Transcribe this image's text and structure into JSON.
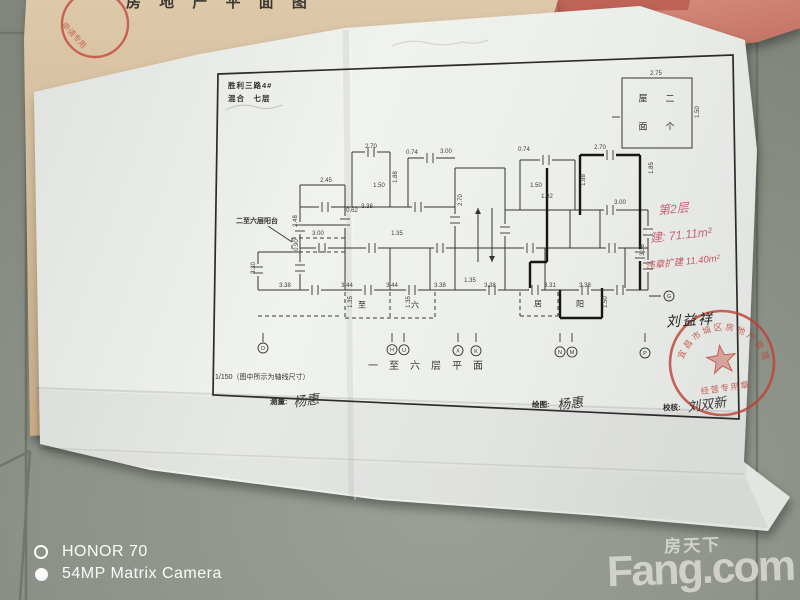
{
  "scene": {
    "floor_color": "#8d9288",
    "grout_color": "#6b7065",
    "tan_paper_color": "#d6bf9f",
    "pink_paper_color": "#d2897b",
    "white_paper_color": "#eceeea",
    "ink_color": "#343434",
    "stamp_red": "#bf4034",
    "hand_red": "#c5566c"
  },
  "watermarks": {
    "camera_line1": "HONOR 70",
    "camera_line2": "54MP Matrix Camera",
    "brand_cn": "房天下",
    "brand_en": "Fang.com"
  },
  "top_paper": {
    "fragment_text": "房 地 产 平 面 图",
    "stamp_text": "申请专用"
  },
  "drawing": {
    "title_line1": "胜利三路4#",
    "title_line2": "混合　七层",
    "roof_box": {
      "dim_top": "2.75",
      "dim_right": "1.50",
      "chars": [
        "屋",
        "二",
        "面",
        "个"
      ]
    },
    "balcony_note": "二至六层阳台",
    "caption": "一至六层平面",
    "scale_note": "1/150（图中所示为轴线尺寸）",
    "sign_measure_label": "测量:",
    "sign_measure_name": "杨惠",
    "sign_draw_label": "绘图:",
    "sign_draw_name": "杨惠",
    "sign_check_label": "校核:",
    "sign_check_name": "刘双新",
    "red_note_line1": "第2层",
    "red_note_line2": "建: 71.11m²",
    "red_note_line3": "违章扩建 11.40m²",
    "owner_name": "刘益祥",
    "axis_right_letter": "G",
    "stamp": {
      "arc_text": "宜昌市城区房地产管理所",
      "bottom_text": "经营专用章"
    },
    "axis_bubbles": [
      {
        "l": "D",
        "x": 263
      },
      {
        "l": "H",
        "x": 392
      },
      {
        "l": "U",
        "x": 404
      },
      {
        "l": "X",
        "x": 458
      },
      {
        "l": "K",
        "x": 476
      },
      {
        "l": "N",
        "x": 560
      },
      {
        "l": "M",
        "x": 572
      },
      {
        "l": "P",
        "x": 645
      }
    ],
    "room_chars": [
      {
        "t": "至",
        "x": 362,
        "y": 305
      },
      {
        "t": "六",
        "x": 415,
        "y": 305
      },
      {
        "t": "居",
        "x": 538,
        "y": 304
      },
      {
        "t": "阳",
        "x": 580,
        "y": 304
      }
    ],
    "roof_chars": [
      {
        "t": "屋",
        "x": 643,
        "y": 98
      },
      {
        "t": "二",
        "x": 670,
        "y": 98
      },
      {
        "t": "面",
        "x": 643,
        "y": 126
      },
      {
        "t": "个",
        "x": 670,
        "y": 126
      }
    ],
    "dim_labels": [
      {
        "t": "2.70",
        "x": 371,
        "y": 147
      },
      {
        "t": "0.74",
        "x": 412,
        "y": 153
      },
      {
        "t": "3.00",
        "x": 446,
        "y": 152
      },
      {
        "t": "0.74",
        "x": 524,
        "y": 150
      },
      {
        "t": "2.70",
        "x": 600,
        "y": 148
      },
      {
        "t": "1.85",
        "x": 652,
        "y": 168,
        "r": 1
      },
      {
        "t": "1.88",
        "x": 396,
        "y": 177,
        "r": 1
      },
      {
        "t": "1.88",
        "x": 584,
        "y": 180,
        "r": 1
      },
      {
        "t": "1.50",
        "x": 379,
        "y": 186
      },
      {
        "t": "0.62",
        "x": 352,
        "y": 211
      },
      {
        "t": "1.50",
        "x": 536,
        "y": 186
      },
      {
        "t": "3.38",
        "x": 367,
        "y": 207
      },
      {
        "t": "1.02",
        "x": 547,
        "y": 197
      },
      {
        "t": "3.00",
        "x": 620,
        "y": 203
      },
      {
        "t": "2.45",
        "x": 326,
        "y": 181
      },
      {
        "t": "2.48",
        "x": 296,
        "y": 221,
        "r": 1
      },
      {
        "t": "3.30",
        "x": 254,
        "y": 268,
        "r": 1
      },
      {
        "t": "2.70",
        "x": 461,
        "y": 200,
        "r": 1
      },
      {
        "t": "1.35",
        "x": 397,
        "y": 234
      },
      {
        "t": "1.35",
        "x": 470,
        "y": 281
      },
      {
        "t": "3.36",
        "x": 643,
        "y": 250,
        "r": 1
      },
      {
        "t": "3.38",
        "x": 285,
        "y": 286
      },
      {
        "t": "3.44",
        "x": 347,
        "y": 286
      },
      {
        "t": "3.44",
        "x": 392,
        "y": 286
      },
      {
        "t": "3.38",
        "x": 440,
        "y": 286
      },
      {
        "t": "3.38",
        "x": 490,
        "y": 286
      },
      {
        "t": "3.31",
        "x": 550,
        "y": 286
      },
      {
        "t": "3.38",
        "x": 585,
        "y": 286
      },
      {
        "t": "1.35",
        "x": 351,
        "y": 302,
        "r": 1
      },
      {
        "t": "1.35",
        "x": 409,
        "y": 302,
        "r": 1
      },
      {
        "t": "1.50",
        "x": 606,
        "y": 302,
        "r": 1
      },
      {
        "t": "3.00",
        "x": 318,
        "y": 234
      },
      {
        "t": "0.90",
        "x": 297,
        "y": 245,
        "r": 1
      },
      {
        "t": "2.75",
        "x": 656,
        "y": 74
      },
      {
        "t": "1.50",
        "x": 698,
        "y": 112,
        "r": 1
      }
    ],
    "plan": {
      "frame": [
        218,
        74,
        733,
        55,
        739,
        419,
        213,
        395
      ],
      "roof_rect": [
        622,
        78,
        70,
        70
      ],
      "walls": [
        [
          258,
          290,
          648,
          290
        ],
        [
          300,
          248,
          648,
          248
        ],
        [
          300,
          207,
          455,
          207
        ],
        [
          505,
          210,
          648,
          210
        ],
        [
          300,
          185,
          345,
          185
        ],
        [
          258,
          252,
          300,
          252
        ],
        [
          258,
          252,
          258,
          290
        ],
        [
          300,
          185,
          300,
          290
        ],
        [
          345,
          185,
          345,
          290
        ],
        [
          390,
          152,
          390,
          207
        ],
        [
          390,
          248,
          390,
          290
        ],
        [
          430,
          248,
          430,
          290
        ],
        [
          455,
          168,
          455,
          290
        ],
        [
          505,
          168,
          505,
          290
        ],
        [
          455,
          168,
          505,
          168
        ],
        [
          352,
          152,
          390,
          152
        ],
        [
          352,
          152,
          352,
          207
        ],
        [
          408,
          158,
          455,
          158
        ],
        [
          408,
          158,
          408,
          207
        ],
        [
          520,
          160,
          575,
          160
        ],
        [
          520,
          160,
          520,
          210
        ],
        [
          575,
          160,
          575,
          210
        ],
        [
          570,
          210,
          570,
          248
        ],
        [
          600,
          210,
          600,
          248
        ],
        [
          625,
          248,
          625,
          290
        ],
        [
          648,
          210,
          648,
          290
        ],
        [
          545,
          248,
          545,
          290
        ],
        [
          300,
          225,
          345,
          225
        ]
      ],
      "bold": [
        [
          580,
          155,
          640,
          155
        ],
        [
          580,
          155,
          580,
          215
        ],
        [
          640,
          155,
          640,
          215
        ],
        [
          640,
          215,
          640,
          290
        ],
        [
          547,
          168,
          547,
          262
        ],
        [
          547,
          262,
          530,
          262
        ],
        [
          530,
          262,
          530,
          290
        ],
        [
          560,
          290,
          560,
          318
        ],
        [
          560,
          318,
          602,
          318
        ],
        [
          602,
          318,
          602,
          288
        ]
      ],
      "dashed": [
        [
          345,
          292,
          345,
          318
        ],
        [
          435,
          292,
          435,
          318
        ],
        [
          345,
          318,
          435,
          318
        ],
        [
          390,
          292,
          390,
          318
        ],
        [
          520,
          292,
          520,
          316
        ],
        [
          558,
          292,
          558,
          316
        ],
        [
          520,
          316,
          558,
          316
        ],
        [
          292,
          238,
          345,
          238
        ],
        [
          292,
          238,
          292,
          252
        ],
        [
          345,
          238,
          345,
          252
        ],
        [
          292,
          252,
          345,
          252
        ],
        [
          258,
          316,
          340,
          316
        ]
      ],
      "windows": [
        [
          315,
          290,
          "h"
        ],
        [
          368,
          290,
          "h"
        ],
        [
          412,
          290,
          "h"
        ],
        [
          492,
          290,
          "h"
        ],
        [
          535,
          290,
          "h"
        ],
        [
          585,
          290,
          "h"
        ],
        [
          620,
          290,
          "h"
        ],
        [
          322,
          248,
          "h"
        ],
        [
          372,
          248,
          "h"
        ],
        [
          440,
          248,
          "h"
        ],
        [
          530,
          248,
          "h"
        ],
        [
          612,
          248,
          "h"
        ],
        [
          325,
          207,
          "h"
        ],
        [
          418,
          207,
          "h"
        ],
        [
          610,
          210,
          "h"
        ],
        [
          371,
          152,
          "h"
        ],
        [
          430,
          158,
          "h"
        ],
        [
          546,
          160,
          "h"
        ],
        [
          610,
          155,
          "h"
        ],
        [
          300,
          228,
          "v"
        ],
        [
          300,
          268,
          "v"
        ],
        [
          345,
          222,
          "v"
        ],
        [
          648,
          232,
          "v"
        ],
        [
          648,
          266,
          "v"
        ],
        [
          258,
          270,
          "v"
        ],
        [
          455,
          220,
          "v"
        ],
        [
          505,
          230,
          "v"
        ],
        [
          640,
          255,
          "v"
        ]
      ],
      "arrows": [
        [
          478,
          262,
          478,
          208
        ],
        [
          492,
          208,
          492,
          262
        ]
      ],
      "leader": [
        268,
        226,
        292,
        242
      ]
    }
  }
}
